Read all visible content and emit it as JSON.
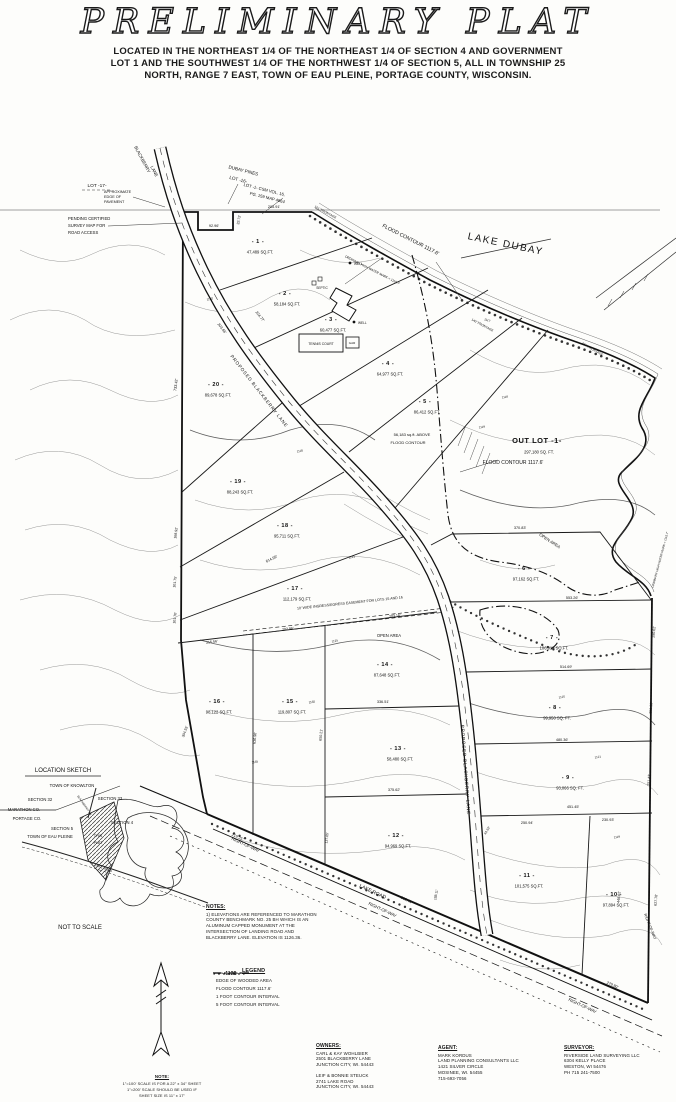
{
  "header": {
    "title": "PRELIMINARY PLAT",
    "subtitle_lines": [
      "LOCATED IN THE NORTHEAST 1/4 OF THE NORTHEAST 1/4 OF SECTION 4 AND GOVERNMENT",
      "LOT 1 AND THE SOUTHWEST 1/4 OF THE NORTHWEST 1/4 OF SECTION 5, ALL IN TOWNSHIP 25",
      "NORTH, RANGE 7 EAST, TOWN OF EAU PLEINE, PORTAGE COUNTY, WISCONSIN."
    ]
  },
  "map": {
    "water_label": "LAKE DUBAY",
    "lots": [
      {
        "id": "- 1 -",
        "sqft": "47,489 SQ.FT.",
        "x": 258,
        "y": 243
      },
      {
        "id": "- 2 -",
        "sqft": "58,184 SQ.FT.",
        "x": 285,
        "y": 295
      },
      {
        "id": "- 3 -",
        "sqft": "60,477 SQ.FT.",
        "x": 331,
        "y": 321
      },
      {
        "id": "- 4 -",
        "sqft": "64,977 SQ.FT.",
        "x": 388,
        "y": 365
      },
      {
        "id": "- 5 -",
        "sqft": "86,412 SQ.FT.",
        "x": 425,
        "y": 403
      },
      {
        "id": "- 6 -",
        "sqft": "97,162 SQ.FT.",
        "x": 524,
        "y": 570
      },
      {
        "id": "- 7 -",
        "sqft": "106,913 SQ.FT.",
        "x": 552,
        "y": 639
      },
      {
        "id": "- 8 -",
        "sqft": "99,950 SQ. FT.",
        "x": 555,
        "y": 709
      },
      {
        "id": "- 9 -",
        "sqft": "93,066 SQ. FT.",
        "x": 568,
        "y": 779
      },
      {
        "id": "- 10 -",
        "sqft": "97,894 SQ.FT.",
        "x": 614,
        "y": 896
      },
      {
        "id": "- 11 -",
        "sqft": "101,575 SQ.FT.",
        "x": 527,
        "y": 877
      },
      {
        "id": "- 12 -",
        "sqft": "94,969 SQ.FT.",
        "x": 396,
        "y": 837
      },
      {
        "id": "- 13 -",
        "sqft": "58,480 SQ.FT.",
        "x": 398,
        "y": 750
      },
      {
        "id": "- 14 -",
        "sqft": "87,648 SQ.FT.",
        "x": 385,
        "y": 666
      },
      {
        "id": "- 15 -",
        "sqft": "119,807 SQ.FT.",
        "x": 290,
        "y": 703
      },
      {
        "id": "- 16 -",
        "sqft": "98,122 SQ.FT.",
        "x": 217,
        "y": 703
      },
      {
        "id": "- 17 -",
        "sqft": "112,179 SQ.FT.",
        "x": 295,
        "y": 590
      },
      {
        "id": "- 18 -",
        "sqft": "95,711 SQ.FT.",
        "x": 285,
        "y": 527
      },
      {
        "id": "- 19 -",
        "sqft": "88,243 SQ.FT.",
        "x": 238,
        "y": 483
      },
      {
        "id": "- 20 -",
        "sqft": "89,678 SQ.FT.",
        "x": 216,
        "y": 386
      },
      {
        "id": "OUT  LOT  -1-",
        "sqft": "297,180 SQ. FT.",
        "x": 537,
        "y": 443,
        "sz": 7.5
      }
    ],
    "annotations": [
      {
        "t": "LOT -17-",
        "x": 97,
        "y": 187,
        "s": 4.8
      },
      {
        "t": "BLACKBERRY",
        "x": 141,
        "y": 160,
        "r": 62,
        "s": 4.4
      },
      {
        "t": "LANE",
        "x": 153,
        "y": 172,
        "r": 62,
        "s": 4.4
      },
      {
        "t": "DUBAY PINES",
        "x": 243,
        "y": 172,
        "r": 14,
        "s": 4.6
      },
      {
        "t": "LOT -16-",
        "x": 238,
        "y": 181,
        "r": 14,
        "s": 4.6
      },
      {
        "t": "LOT -1- CSM VOL. 16,",
        "x": 264,
        "y": 191,
        "r": 14,
        "s": 4.2
      },
      {
        "t": "PG. 159 MAP 4664",
        "x": 267,
        "y": 199,
        "r": 14,
        "s": 4.2
      },
      {
        "t": "APPROXIMATE",
        "x": 104,
        "y": 193,
        "s": 3.8,
        "a": "s"
      },
      {
        "t": "EDGE OF",
        "x": 104,
        "y": 198,
        "s": 3.8,
        "a": "s"
      },
      {
        "t": "PAVEMENT",
        "x": 104,
        "y": 203,
        "s": 3.8,
        "a": "s"
      },
      {
        "t": "PENDING CERTIFIED",
        "x": 68,
        "y": 220,
        "s": 4.2,
        "a": "s"
      },
      {
        "t": "SURVEY MAP FOR",
        "x": 68,
        "y": 227,
        "s": 4.2,
        "a": "s"
      },
      {
        "t": "ROAD ACCESS",
        "x": 68,
        "y": 234,
        "s": 4.2,
        "a": "s"
      },
      {
        "t": "92.96'",
        "x": 214,
        "y": 227,
        "s": 3.8
      },
      {
        "t": "32.72'",
        "x": 240,
        "y": 220,
        "r": -80,
        "s": 3.6
      },
      {
        "t": "205.91'",
        "x": 274,
        "y": 208,
        "s": 3.8
      },
      {
        "t": "LAKE DUBAY",
        "x": 505,
        "y": 247,
        "r": 12,
        "s": 10,
        "ls": 1.5
      },
      {
        "t": "FLOOD CONTOUR 1117.6'",
        "x": 410,
        "y": 241,
        "r": 27,
        "s": 5.2
      },
      {
        "t": "ORDINARY HIGH WATER MARK = 1115.7'",
        "x": 372,
        "y": 271,
        "r": 27,
        "s": 3.2
      },
      {
        "t": "101' FRONTAGE",
        "x": 325,
        "y": 213,
        "r": 28,
        "s": 3.2
      },
      {
        "t": "140' FRONTAGE",
        "x": 482,
        "y": 326,
        "r": 28,
        "s": 3.2
      },
      {
        "t": "434' FRONTAGE",
        "x": 592,
        "y": 350,
        "r": 30,
        "s": 3.2
      },
      {
        "t": "1117",
        "x": 487,
        "y": 321,
        "r": 18,
        "s": 3,
        "g": 1
      },
      {
        "t": "FLOOD CONTOUR 1117.6'",
        "x": 513,
        "y": 464,
        "s": 5
      },
      {
        "t": "56,183 sq.ft. ABOVE",
        "x": 412,
        "y": 436,
        "s": 4
      },
      {
        "t": "FLOOD CONTOUR",
        "x": 408,
        "y": 444,
        "s": 4
      },
      {
        "t": "OPEN AREA",
        "x": 389,
        "y": 637,
        "s": 4.2
      },
      {
        "t": "OPEN AREA",
        "x": 549,
        "y": 542,
        "r": 33,
        "s": 4.2
      },
      {
        "t": "10' WIDE INGRESS/EGRESS EASEMENT FOR LOTS 15 AND 16",
        "x": 350,
        "y": 604,
        "r": -6,
        "s": 3.6
      },
      {
        "t": "215.56'",
        "x": 212,
        "y": 643,
        "r": -7,
        "s": 3.6
      },
      {
        "t": "202.96'",
        "x": 288,
        "y": 630,
        "r": -7,
        "s": 3.6
      },
      {
        "t": "203.16'",
        "x": 395,
        "y": 617,
        "r": -7,
        "s": 3.6
      },
      {
        "t": "614.99'",
        "x": 272,
        "y": 560,
        "r": -26,
        "s": 3.8
      },
      {
        "t": "553.26'",
        "x": 572,
        "y": 599,
        "s": 3.8
      },
      {
        "t": "370.83'",
        "x": 520,
        "y": 529,
        "s": 3.8
      },
      {
        "t": "514.69'",
        "x": 566,
        "y": 668,
        "s": 3.8
      },
      {
        "t": "480.36'",
        "x": 562,
        "y": 741,
        "s": 3.8
      },
      {
        "t": "451.45'",
        "x": 573,
        "y": 808,
        "s": 3.8
      },
      {
        "t": "250.94'",
        "x": 527,
        "y": 824,
        "s": 3.8
      },
      {
        "t": "230.93'",
        "x": 608,
        "y": 821,
        "s": 3.8
      },
      {
        "t": "336.51'",
        "x": 383,
        "y": 703,
        "s": 3.8
      },
      {
        "t": "375.62'",
        "x": 394,
        "y": 791,
        "s": 3.8
      },
      {
        "t": "733.42'",
        "x": 177,
        "y": 385,
        "r": -83,
        "s": 3.8
      },
      {
        "t": "168.92'",
        "x": 177,
        "y": 533,
        "r": -83,
        "s": 3.6
      },
      {
        "t": "101.75'",
        "x": 176,
        "y": 582,
        "r": -83,
        "s": 3.6
      },
      {
        "t": "101.70'",
        "x": 176,
        "y": 618,
        "r": -83,
        "s": 3.6
      },
      {
        "t": "304.55'",
        "x": 186,
        "y": 732,
        "r": -70,
        "s": 3.6
      },
      {
        "t": "224.77'",
        "x": 259,
        "y": 317,
        "r": 52,
        "s": 3.8
      },
      {
        "t": "203.66'",
        "x": 221,
        "y": 329,
        "r": 52,
        "s": 3.8
      },
      {
        "t": "PROPOSED BLACKBERRY LANE",
        "x": 258,
        "y": 392,
        "r": 52,
        "s": 4.6,
        "ls": 0.8
      },
      {
        "t": "PROPOSED BLACKBERRY LANE",
        "x": 464,
        "y": 770,
        "r": 86,
        "s": 4.6,
        "ls": 0.8
      },
      {
        "t": "290.62'",
        "x": 655,
        "y": 632,
        "r": -85,
        "s": 3.6
      },
      {
        "t": "259.98'",
        "x": 652,
        "y": 708,
        "r": -85,
        "s": 3.6
      },
      {
        "t": "251.43'",
        "x": 650,
        "y": 780,
        "r": -85,
        "s": 3.6
      },
      {
        "t": "627.78'",
        "x": 657,
        "y": 900,
        "r": -85,
        "s": 3.6
      },
      {
        "t": "448.62'",
        "x": 620,
        "y": 897,
        "r": -85,
        "s": 3.6
      },
      {
        "t": "RIGHT-OF-WAY",
        "x": 245,
        "y": 846,
        "r": 25,
        "s": 4.2
      },
      {
        "t": "LAKE ROAD",
        "x": 372,
        "y": 893,
        "r": 25,
        "s": 5
      },
      {
        "t": "313.41'",
        "x": 406,
        "y": 901,
        "r": 25,
        "s": 3.8
      },
      {
        "t": "RIGHT-OF-WAY",
        "x": 382,
        "y": 911,
        "r": 25,
        "s": 4.2
      },
      {
        "t": "RIGHT-OF-WAY",
        "x": 582,
        "y": 1007,
        "r": 25,
        "s": 4.2
      },
      {
        "t": "279.80'",
        "x": 612,
        "y": 986,
        "r": 25,
        "s": 3.8
      },
      {
        "t": "RIGHT-OF-WAY",
        "x": 649,
        "y": 927,
        "r": 68,
        "s": 3.8
      },
      {
        "t": "219.25'",
        "x": 237,
        "y": 838,
        "r": 25,
        "s": 3.8
      },
      {
        "t": "TENNIS COURT",
        "x": 321,
        "y": 345,
        "s": 3.4
      },
      {
        "t": "GAR",
        "x": 352,
        "y": 344,
        "s": 3
      },
      {
        "t": "WELL",
        "x": 358,
        "y": 324,
        "s": 3.2,
        "a": "s"
      },
      {
        "t": "WELL",
        "x": 354,
        "y": 265,
        "s": 3.2,
        "a": "s"
      },
      {
        "t": "SEPTIC",
        "x": 322,
        "y": 289,
        "s": 3.2
      },
      {
        "t": "ORDINARY HIGH WATER MARK = 1115.7'",
        "x": 661,
        "y": 560,
        "r": -75,
        "s": 3
      },
      {
        "t": "188.11'",
        "x": 437,
        "y": 895,
        "r": -80,
        "s": 3.4
      },
      {
        "t": "44.62'",
        "x": 488,
        "y": 831,
        "r": -60,
        "s": 3.4
      },
      {
        "t": "137.65'",
        "x": 328,
        "y": 838,
        "r": -85,
        "s": 3.4
      },
      {
        "t": "636.96'",
        "x": 256,
        "y": 738,
        "r": -85,
        "s": 3.6
      },
      {
        "t": "650.21'",
        "x": 322,
        "y": 735,
        "r": -85,
        "s": 3.6
      },
      {
        "t": "1118",
        "x": 505,
        "y": 398,
        "r": -8,
        "s": 3,
        "g": 1
      },
      {
        "t": "1119",
        "x": 482,
        "y": 428,
        "r": -8,
        "s": 3,
        "g": 1
      },
      {
        "t": "1121",
        "x": 352,
        "y": 558,
        "r": -14,
        "s": 3,
        "g": 1
      },
      {
        "t": "1125",
        "x": 335,
        "y": 642,
        "r": -12,
        "s": 3,
        "g": 1
      },
      {
        "t": "1130",
        "x": 312,
        "y": 703,
        "r": -10,
        "s": 3,
        "g": 1
      },
      {
        "t": "1135",
        "x": 255,
        "y": 763,
        "r": -10,
        "s": 3,
        "g": 1
      },
      {
        "t": "1125",
        "x": 562,
        "y": 698,
        "r": -8,
        "s": 3,
        "g": 1
      },
      {
        "t": "1121",
        "x": 598,
        "y": 758,
        "r": -8,
        "s": 3,
        "g": 1
      },
      {
        "t": "1119",
        "x": 617,
        "y": 838,
        "r": -8,
        "s": 3,
        "g": 1
      },
      {
        "t": "1118",
        "x": 300,
        "y": 452,
        "r": -12,
        "s": 3,
        "g": 1
      },
      {
        "t": "1120",
        "x": 210,
        "y": 300,
        "r": -12,
        "s": 3,
        "g": 1
      }
    ]
  },
  "location_sketch": {
    "labels": [
      {
        "t": "LOCATION SKETCH",
        "x": 63,
        "y": 772,
        "s": 6
      },
      {
        "t": "TOWN OF KNOWLTON",
        "x": 72,
        "y": 787,
        "s": 4.2
      },
      {
        "t": "SECTION 32",
        "x": 40,
        "y": 801,
        "s": 4.2
      },
      {
        "t": "SECTION 33",
        "x": 110,
        "y": 800,
        "s": 4.2
      },
      {
        "t": "MARATHON CO.",
        "x": 24,
        "y": 811,
        "s": 4.2
      },
      {
        "t": "PORTAGE CO.",
        "x": 27,
        "y": 820,
        "s": 4.2
      },
      {
        "t": "SECTION 5",
        "x": 62,
        "y": 830,
        "s": 4.2
      },
      {
        "t": "SECTION 4",
        "x": 122,
        "y": 824,
        "s": 4.2
      },
      {
        "t": "TOWN OF EAU PLEINE",
        "x": 50,
        "y": 838,
        "s": 4.2
      },
      {
        "t": "THIS",
        "x": 98,
        "y": 837,
        "s": 3.6
      },
      {
        "t": "PLAT",
        "x": 98,
        "y": 844,
        "s": 3.6
      },
      {
        "t": "BLACKBERRY LN.",
        "x": 84,
        "y": 806,
        "r": 55,
        "s": 2.8
      },
      {
        "t": "LAKE ROAD",
        "x": 103,
        "y": 869,
        "r": 22,
        "s": 3.2
      },
      {
        "t": "NOT TO SCALE",
        "x": 80,
        "y": 929,
        "s": 6
      }
    ]
  },
  "notes": {
    "title": "NOTES:",
    "lines": [
      "1) ELEVATIONS ARE REFERENCED TO MARATHON",
      "COUNTY BENCHMARK  NO. 25 BH WHICH IS AN",
      "ALUMINUM CAPPED MONUMENT AT THE",
      "INTERSECTION OF LANDING ROAD AND",
      "BLACKBERRY LANE.  ELEVATION IS 1126.36."
    ]
  },
  "legend": {
    "title": "LEGEND",
    "items": [
      {
        "label": "EDGE OF WOODED AREA"
      },
      {
        "label": "FLOOD CONTOUR 1117.6'"
      },
      {
        "symbol_label": "1121",
        "label": "1 FOOT CONTOUR INTERVAL"
      },
      {
        "symbol_label": "1125",
        "label": "5 FOOT CONTOUR INTERVAL"
      }
    ]
  },
  "scale_note": {
    "title": "NOTE:",
    "lines": [
      "1\"=100' SCALE IS FOR A 22\" x 34\" SHEET",
      "1\"=200' SCALE SHOULD BE USED IF",
      "SHEET SIZE IS 11\" x 17\""
    ]
  },
  "contacts": {
    "owners": {
      "title": "OWNERS:",
      "group1": [
        "CARL & KAY WOHLBIER",
        "2501 BLACKBERRY LANE",
        "JUNCTION CITY, WI. 54443"
      ],
      "group2": [
        "LEIF & BONNIE STEUCK",
        "2741 LAKE ROAD",
        "JUNCTION CITY, WI. 54443"
      ]
    },
    "agent": {
      "title": "AGENT:",
      "lines": [
        "MARK KORDUS",
        "LAND PLANNING CONSULTANTS LLC",
        "1421 SILVER CIRCLE",
        "MOSINEE, WI.  54455",
        "715-693-7056"
      ]
    },
    "surveyor": {
      "title": "SURVEYOR:",
      "lines": [
        "RIVERSIDE LAND SURVEYING LLC",
        "6304 KELLY PLACE",
        "WESTON, WI 54476",
        "PH 715 241-7500"
      ]
    }
  }
}
